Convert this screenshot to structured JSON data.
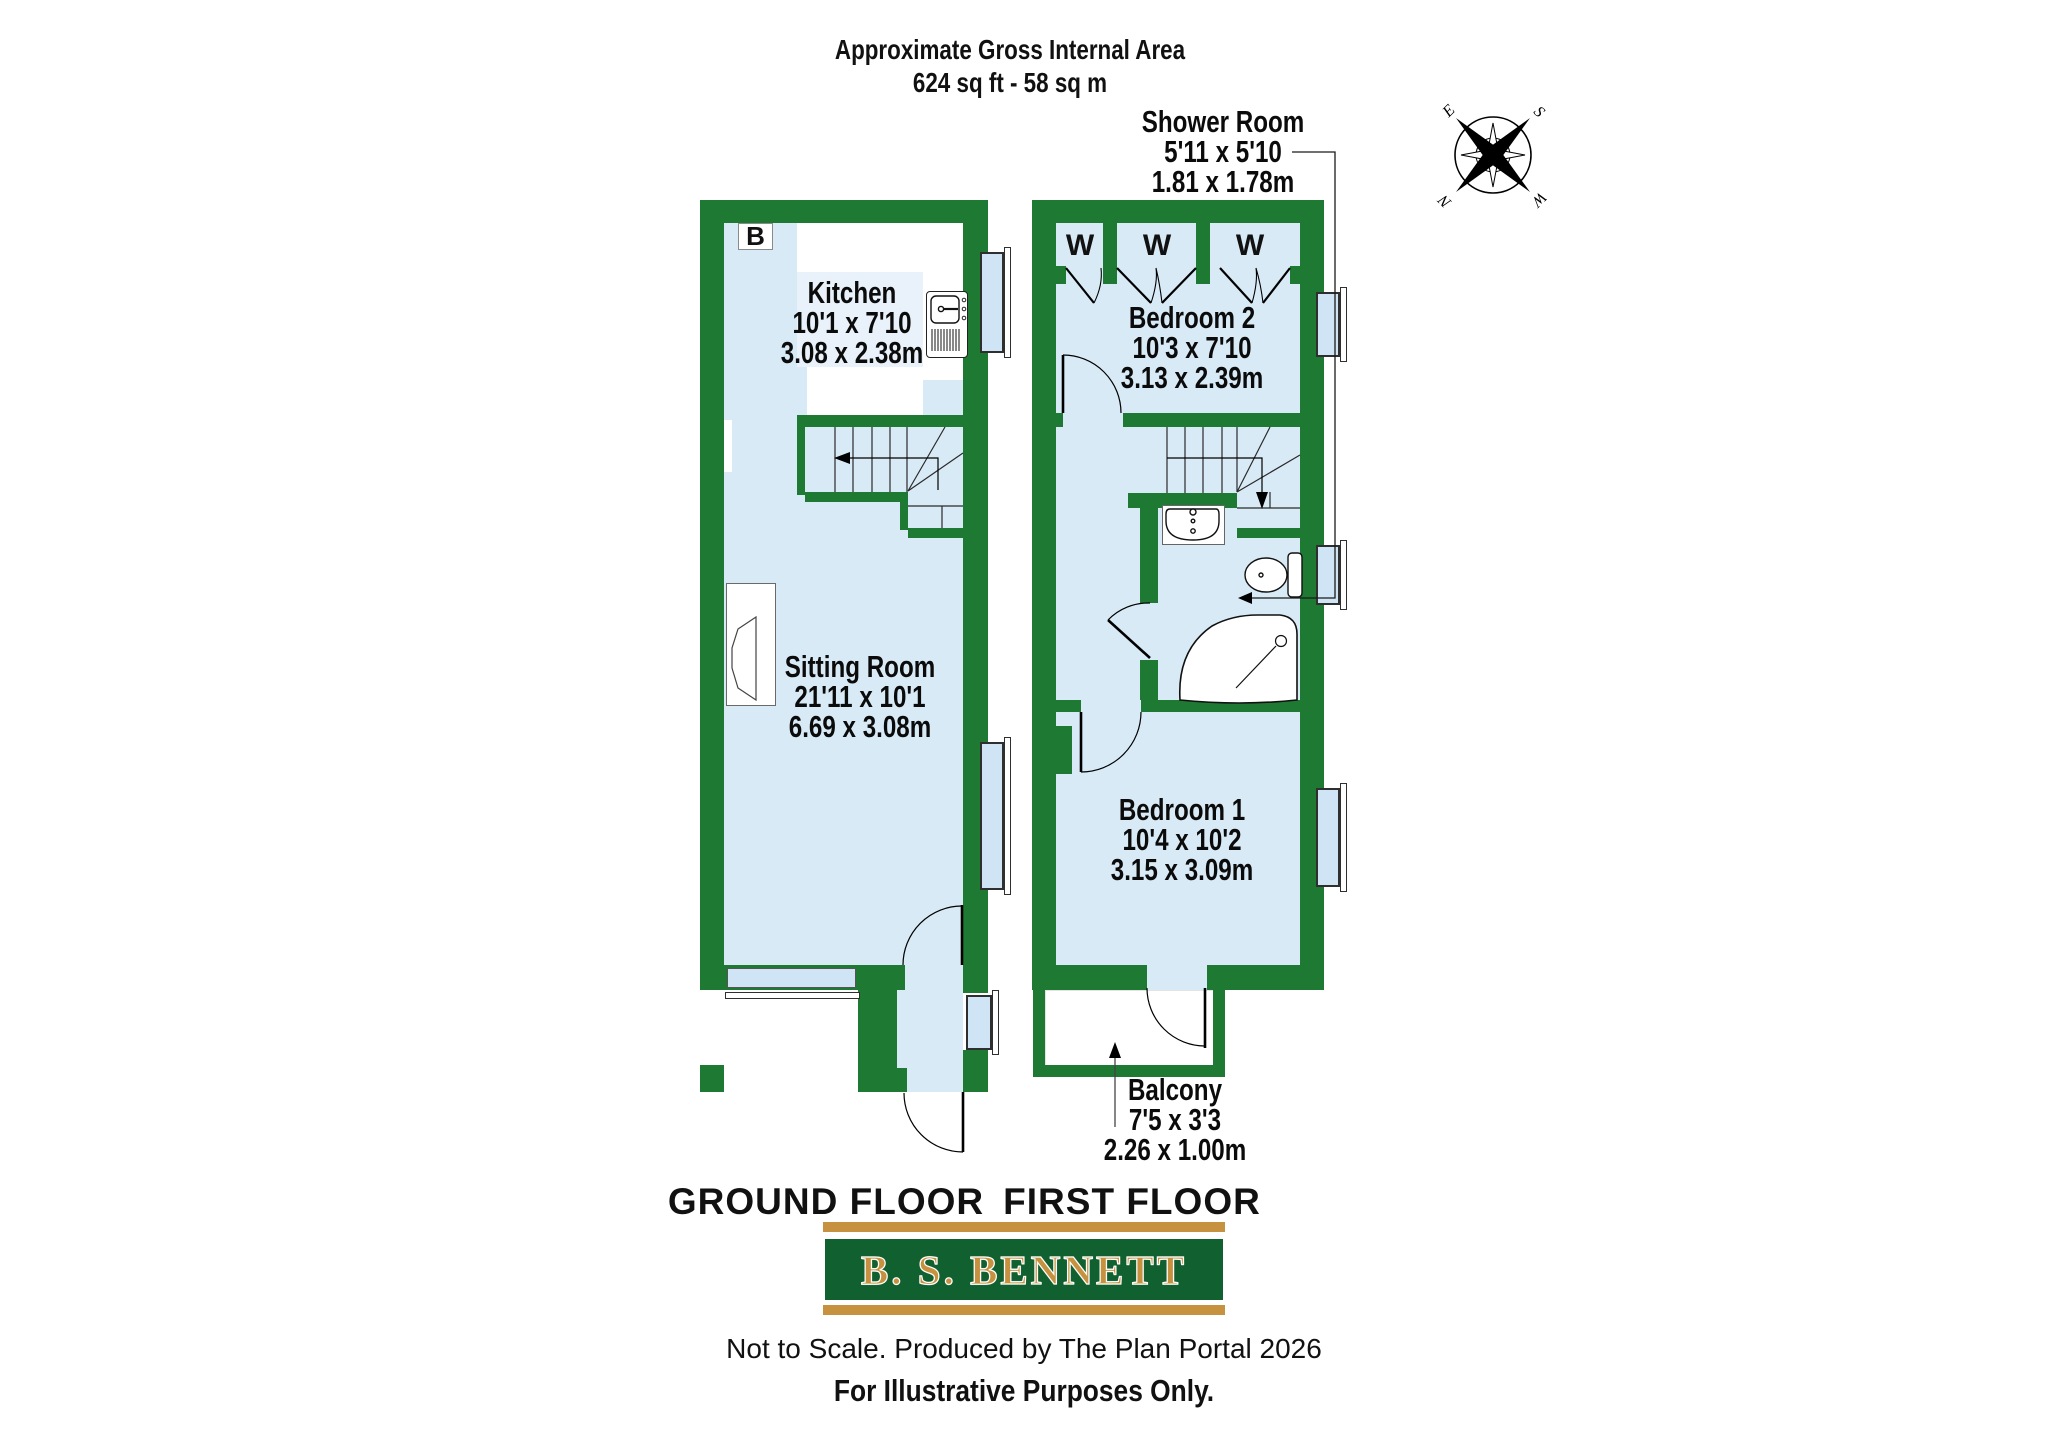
{
  "header": {
    "title_line1": "Approximate Gross Internal Area",
    "title_line2": "624 sq ft - 58 sq m"
  },
  "ground_floor": {
    "title": "GROUND FLOOR",
    "boiler_label": "B",
    "rooms": {
      "kitchen": {
        "name": "Kitchen",
        "imperial": "10'1 x 7'10",
        "metric": "3.08 x 2.38m"
      },
      "sitting_room": {
        "name": "Sitting Room",
        "imperial": "21'11 x 10'1",
        "metric": "6.69 x 3.08m"
      }
    }
  },
  "first_floor": {
    "title": "FIRST FLOOR",
    "wardrobes": [
      "W",
      "W",
      "W"
    ],
    "rooms": {
      "bedroom2": {
        "name": "Bedroom 2",
        "imperial": "10'3 x 7'10",
        "metric": "3.13 x 2.39m"
      },
      "bedroom1": {
        "name": "Bedroom 1",
        "imperial": "10'4 x 10'2",
        "metric": "3.15 x 3.09m"
      },
      "shower_room": {
        "name": "Shower Room",
        "imperial": "5'11 x 5'10",
        "metric": "1.81 x 1.78m"
      },
      "balcony": {
        "name": "Balcony",
        "imperial": "7'5 x 3'3",
        "metric": "2.26 x 1.00m"
      }
    }
  },
  "compass": {
    "n": "N",
    "e": "E",
    "s": "S",
    "w": "W"
  },
  "branding": {
    "agency": "B. S. BENNETT"
  },
  "footer": {
    "line1": "Not to Scale. Produced by The Plan Portal 2026",
    "line2": "For Illustrative Purposes Only."
  },
  "colors": {
    "wall_green": "#1e7a33",
    "floor_blue": "#d9eaf7",
    "window_blue": "#cfe4f4",
    "label_bg": "#e9f2fa",
    "banner_green": "#11602f",
    "gold": "#c6923f"
  }
}
